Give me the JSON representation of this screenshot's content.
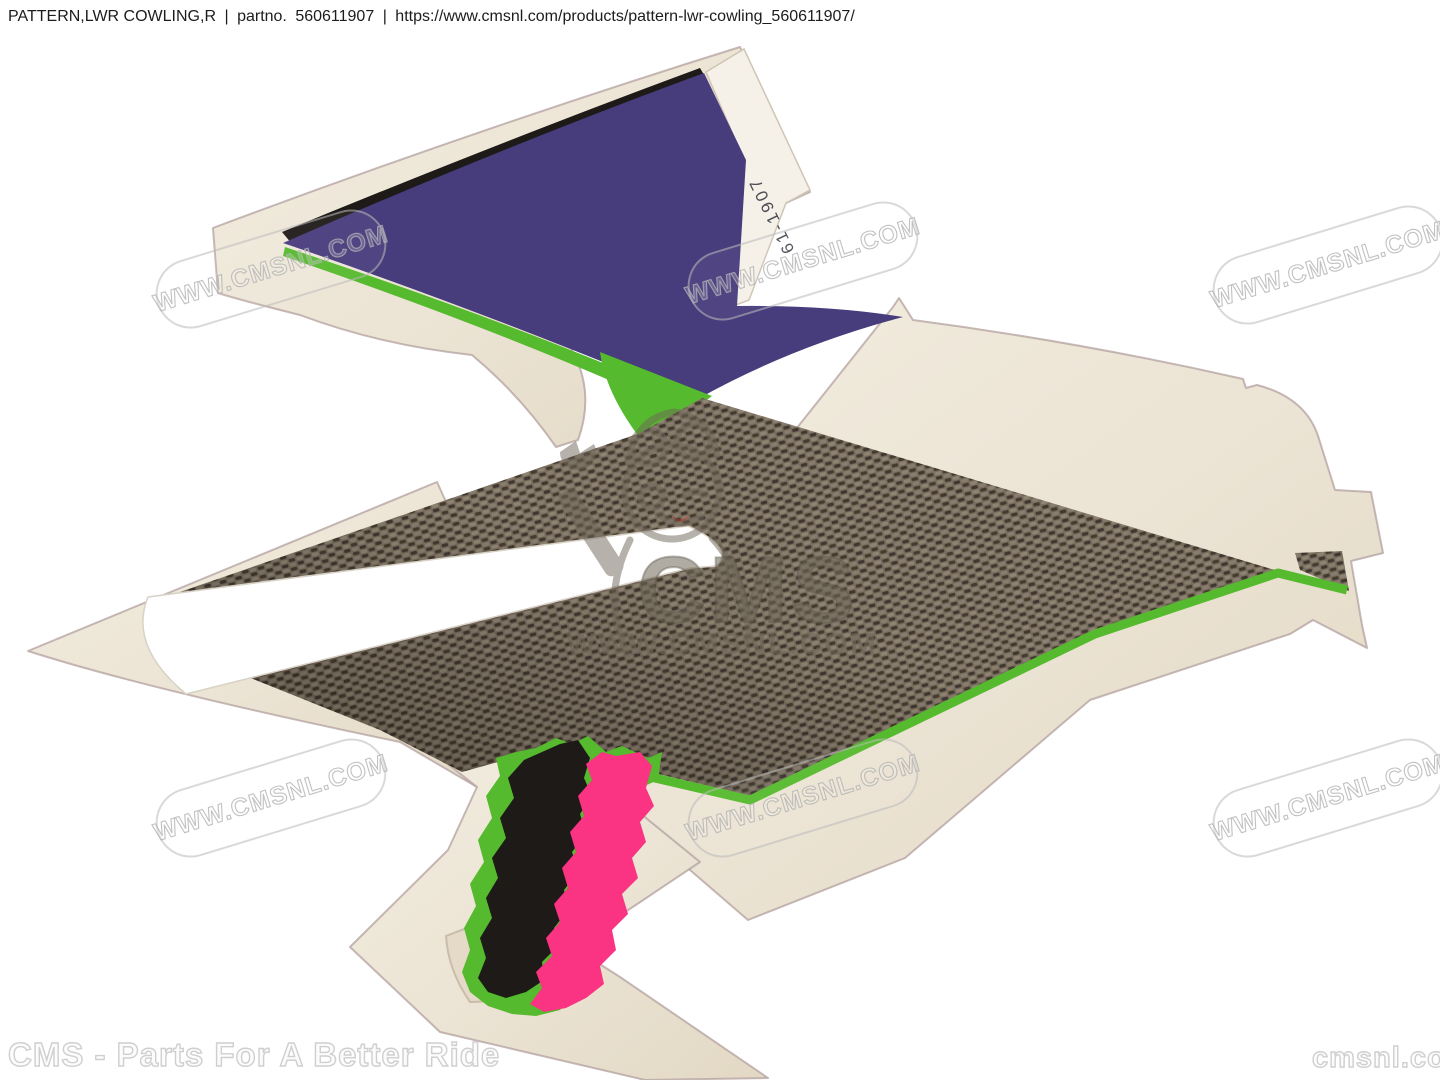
{
  "header": {
    "title": "PATTERN,LWR COWLING,R",
    "separator1": "|",
    "partno_label": "partno.",
    "partno": "560611907",
    "separator2": "|",
    "url": "https://www.cmsnl.com/products/pattern-lwr-cowling_560611907/"
  },
  "part": {
    "sticker_code": "61-1907"
  },
  "watermark": {
    "text": "WWW.CMSNL.COM"
  },
  "logo": {
    "name": "CMS",
    "url": "WWW.CMSNL.COM"
  },
  "footer": {
    "left": "CMS - Parts For A Better Ride",
    "right": "cmsnl.com"
  },
  "colors": {
    "background": "#ffffff",
    "cream": "#ebe3d3",
    "cream_light": "#f3eee3",
    "edge": "#b3a09f",
    "purple": "#473c7c",
    "black": "#1d1a17",
    "green": "#55ba2d",
    "pink": "#fa3382",
    "carbon_base": "#786d5e",
    "carbon_dark": "#423a2e",
    "carbon_light": "#8f8373",
    "watermark_gray": "#bababa",
    "logo_gray": "#6f675a",
    "tongue_red": "#b5342f"
  }
}
